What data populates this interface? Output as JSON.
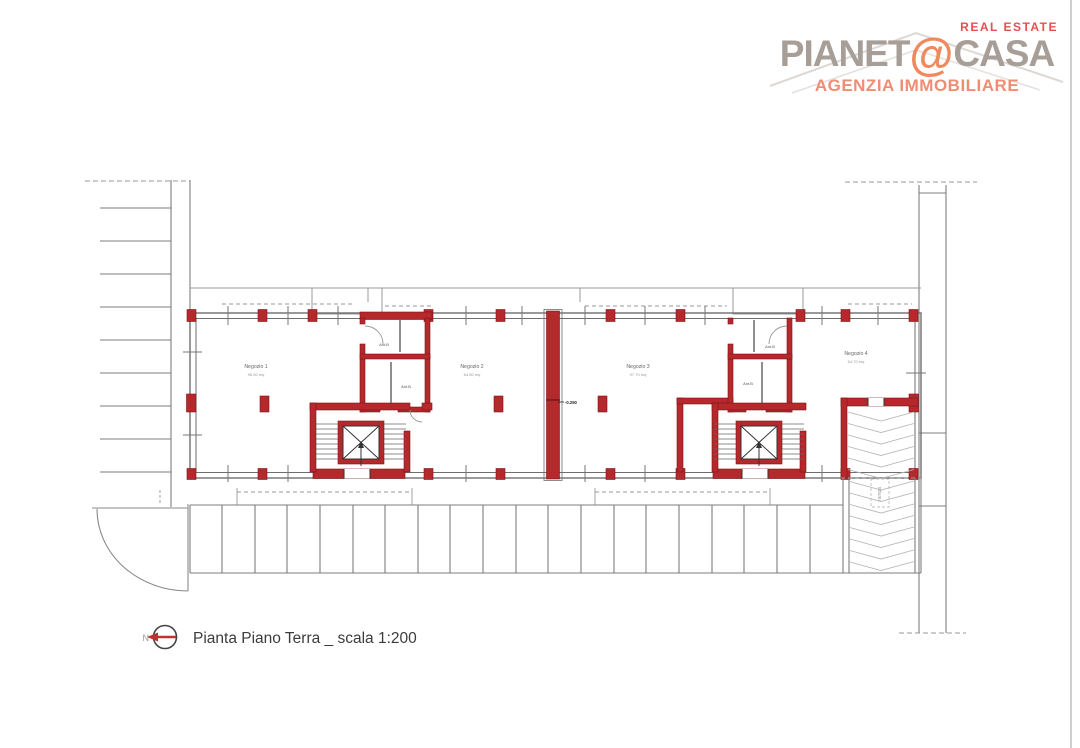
{
  "logo": {
    "real_estate": "REAL ESTATE",
    "name_left": "PIANET",
    "name_at": "@",
    "name_right": "CASA",
    "subtitle": "AGENZIA IMMOBILIARE",
    "colors": {
      "brand_gray": "#a89e98",
      "accent_orange": "#ef8a5f",
      "red": "#e84f4f",
      "salmon": "#ee8d74"
    }
  },
  "plan": {
    "shops": [
      {
        "name": "Negozio 1",
        "area": "96.00 mq"
      },
      {
        "name": "Negozio 2",
        "area": "64.80 mq"
      },
      {
        "name": "Negozio 3",
        "area": "97.70 mq"
      },
      {
        "name": "Negozio 4",
        "area": "64.70 mq"
      }
    ],
    "service_rooms": [
      {
        "label": "Ant.B"
      },
      {
        "label": "Ant.B"
      },
      {
        "label": "Ant.B"
      },
      {
        "label": "Ant.B"
      }
    ],
    "level_marker": "-0.250",
    "ramp_label": "rampa",
    "colors": {
      "wall_red": "#b5282c",
      "line_gray": "#6e6e6e"
    }
  },
  "caption": {
    "north_letter": "N",
    "title": "Pianta Piano Terra _ scala 1:200"
  }
}
